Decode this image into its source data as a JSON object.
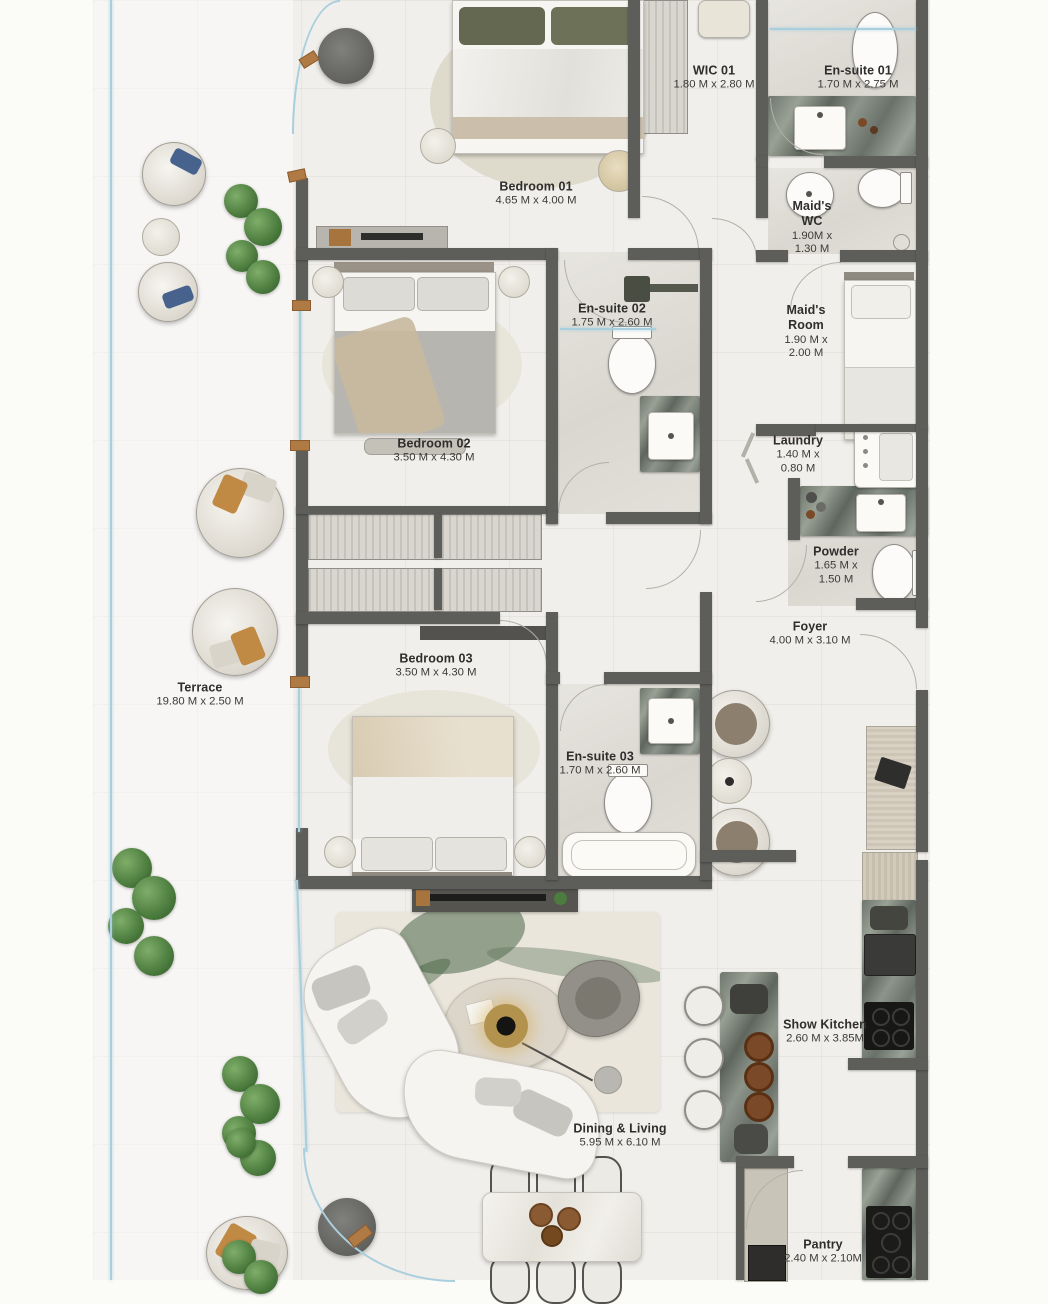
{
  "plan": {
    "type": "residential-floor-plan",
    "rooms": [
      {
        "id": "bedroom-01",
        "name": "Bedroom 01",
        "dims": "4.65 M x 4.00 M"
      },
      {
        "id": "wic-01",
        "name": "WIC 01",
        "dims": "1.80 M x 2.80 M"
      },
      {
        "id": "ensuite-01",
        "name": "En-suite 01",
        "dims": "1.70 M x 2.75 M"
      },
      {
        "id": "maids-wc",
        "name": "Maid's WC",
        "dims": "1.90M x 1.30 M"
      },
      {
        "id": "maids-room",
        "name": "Maid's Room",
        "dims": "1.90 M x 2.00 M"
      },
      {
        "id": "ensuite-02",
        "name": "En-suite 02",
        "dims": "1.75 M x 2.60 M"
      },
      {
        "id": "bedroom-02",
        "name": "Bedroom 02",
        "dims": "3.50 M x 4.30 M"
      },
      {
        "id": "laundry",
        "name": "Laundry",
        "dims": "1.40 M x 0.80 M"
      },
      {
        "id": "powder",
        "name": "Powder",
        "dims": "1.65 M x 1.50 M"
      },
      {
        "id": "foyer",
        "name": "Foyer",
        "dims": "4.00 M x 3.10 M"
      },
      {
        "id": "bedroom-03",
        "name": "Bedroom 03",
        "dims": "3.50 M x 4.30 M"
      },
      {
        "id": "terrace",
        "name": "Terrace",
        "dims": "19.80 M x 2.50 M"
      },
      {
        "id": "ensuite-03",
        "name": "En-suite 03",
        "dims": "1.70 M x 2.60 M"
      },
      {
        "id": "show-kitchen",
        "name": "Show Kitchen",
        "dims": "2.60 M x 3.85M"
      },
      {
        "id": "dining-living",
        "name": "Dining & Living",
        "dims": "5.95 M x 6.10 M"
      },
      {
        "id": "pantry",
        "name": "Pantry",
        "dims": "2.40 M x 2.10M"
      }
    ],
    "colors": {
      "wall": "#5d5d5a",
      "floor": "#f1efeb",
      "bath_floor": "#e0ddd6",
      "marble_counter": "#79817666",
      "glass": "#a9cede",
      "wood_accent": "#b07a44",
      "plant_green": "#4c7c3e",
      "label_text": "#2f2e2c"
    }
  }
}
